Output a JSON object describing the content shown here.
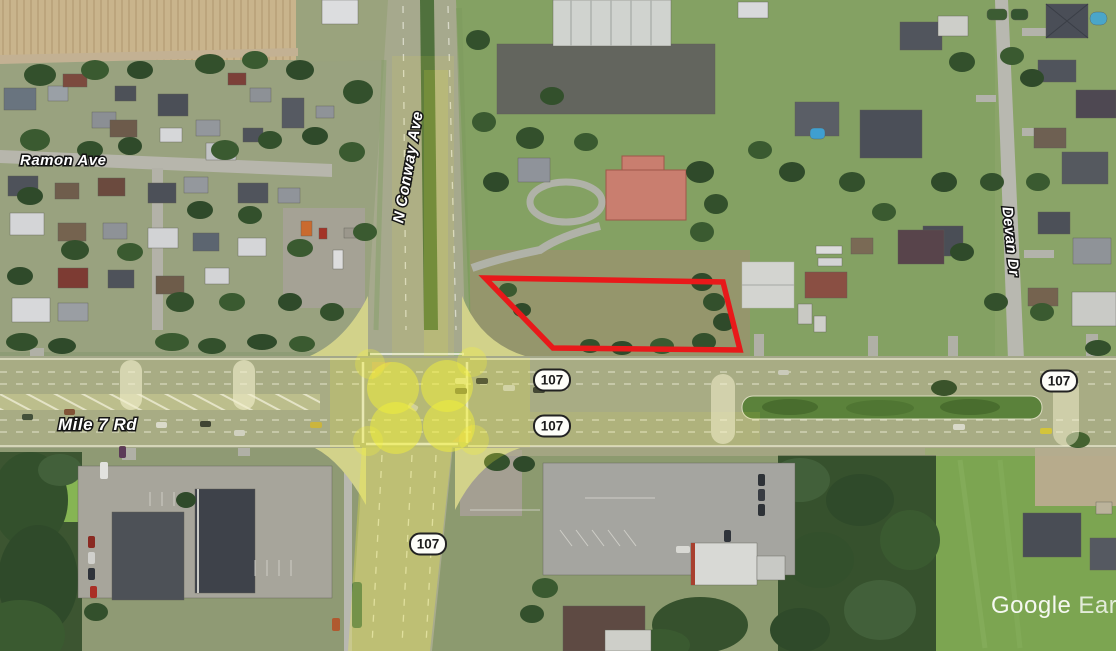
{
  "map": {
    "street_labels": {
      "ramon_ave": "Ramon Ave",
      "n_conway_ave": "N Conway Ave",
      "mile_7_rd": "Mile 7 Rd",
      "devan_dr": "Devan Dr"
    },
    "route_shields": [
      {
        "label": "107"
      },
      {
        "label": "107"
      },
      {
        "label": "107"
      },
      {
        "label": "107"
      }
    ],
    "watermark": {
      "brand": "Google",
      "product": "Earth"
    },
    "annotation": {
      "parcel_outline_color": "#e8191a",
      "highlight_color": "#f2ef3a"
    }
  }
}
